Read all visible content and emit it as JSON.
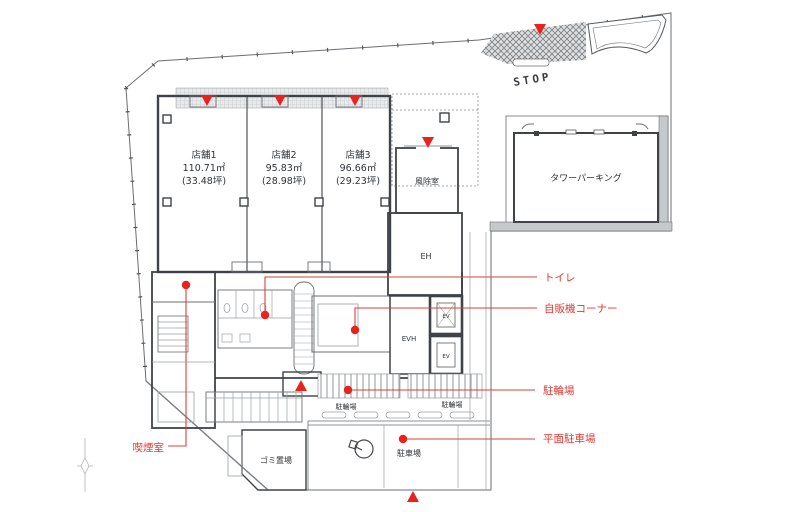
{
  "plan": {
    "stores": [
      {
        "name": "店舗1",
        "area_m2": "110.71㎡",
        "area_tsubo": "(33.48坪)"
      },
      {
        "name": "店舗2",
        "area_m2": "95.83㎡",
        "area_tsubo": "(28.98坪)"
      },
      {
        "name": "店舗3",
        "area_m2": "96.66㎡",
        "area_tsubo": "(29.23坪)"
      }
    ],
    "rooms": {
      "windbreak": "風除室",
      "tower_parking": "タワーパーキング",
      "entrance_hall": "EH",
      "elevator_hall": "EVH",
      "elevator": "EV",
      "bicycle_parking": "駐輪場",
      "garbage": "ゴミ置場",
      "parking": "駐車場"
    },
    "site_text": {
      "stop": "STOP"
    },
    "annotations": {
      "toilet": "トイレ",
      "vending_corner": "自販機コーナー",
      "bicycle_parking": "駐輪場",
      "surface_parking": "平面駐車場",
      "smoking_room": "喫煙室"
    },
    "colors": {
      "annotation_red": "#e8231e",
      "leader_red": "#d9413c",
      "line_gray": "#3f4347",
      "wall_fill_gray": "#c6c9cc"
    }
  }
}
